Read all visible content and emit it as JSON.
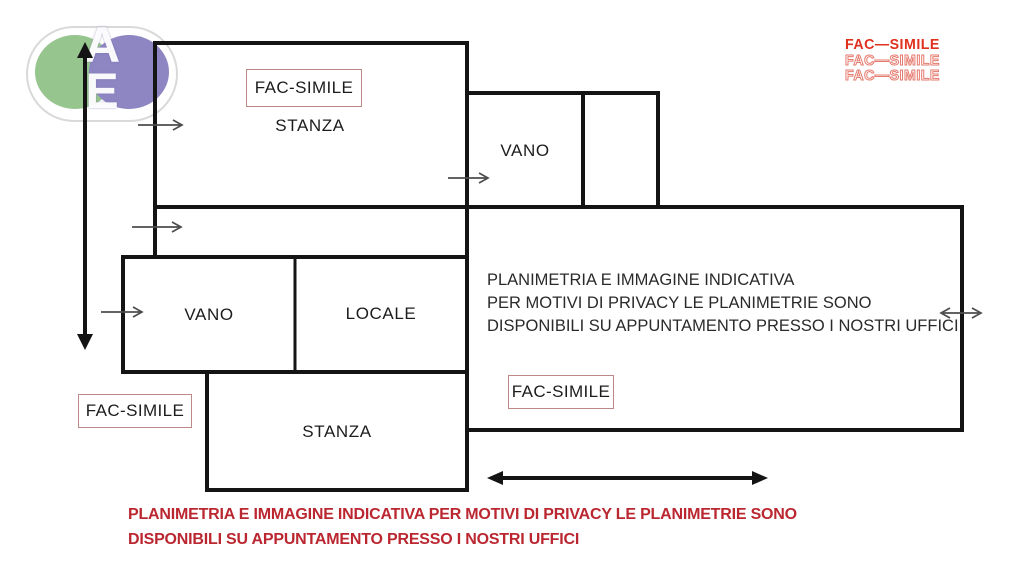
{
  "logo": {
    "letter_top": "A",
    "letter_bottom": "E",
    "green": "#97c58e",
    "purple": "#8d86c3"
  },
  "watermark": {
    "color_solid": "#e0301e",
    "lines": [
      "FAC—SIMILE",
      "FAC—SIMILE",
      "FAC—SIMILE"
    ]
  },
  "rooms": {
    "stanza_top": "STANZA",
    "vano_top": "VANO",
    "vano_left": "VANO",
    "locale": "LOCALE",
    "stanza_bottom": "STANZA"
  },
  "fac_simile": {
    "top_box": "FAC-SIMILE",
    "center_box": "FAC-SIMILE",
    "bottom_left_box": "FAC-SIMILE",
    "border_color": "#bd8888"
  },
  "privacy_notice": {
    "line1": "PLANIMETRIA E IMMAGINE INDICATIVA",
    "line2": "PER MOTIVI DI PRIVACY LE PLANIMETRIE SONO",
    "line3": "DISPONIBILI SU APPUNTAMENTO PRESSO I NOSTRI UFFICI"
  },
  "footer_notice": {
    "color": "#bb2730",
    "line1": "PLANIMETRIA E IMMAGINE INDICATIVA PER MOTIVI DI PRIVACY LE PLANIMETRIE SONO",
    "line2": "DISPONIBILI SU APPUNTAMENTO PRESSO I NOSTRI UFFICI"
  },
  "colors": {
    "wall": "#141414",
    "arrow_gray": "#4d4d4d"
  }
}
